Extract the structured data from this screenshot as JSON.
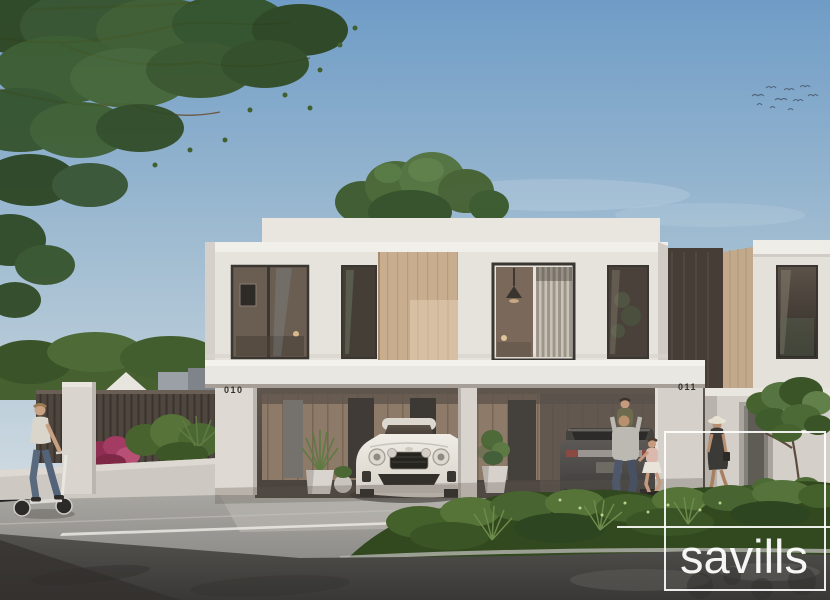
{
  "watermark": {
    "label": "savills"
  },
  "units": [
    {
      "number": "010"
    },
    {
      "number": "011"
    }
  ],
  "palette": {
    "sky_top": "#6f9cc6",
    "sky_horizon": "#ccd8e0",
    "wall_white": "#e6e3dd",
    "wood_panel": "#c9ad8f",
    "carport_wood": "#8d7a68",
    "fence_dark": "#4e463f",
    "foliage_dark": "#2c451f",
    "foliage_mid": "#3e5c2e",
    "magenta_shrub": "#a43b62",
    "pavement": "#a8a6a1",
    "asphalt_dark": "#3c3b39",
    "watermark_white": "#ffffff",
    "house_number_color": "#34312d"
  }
}
